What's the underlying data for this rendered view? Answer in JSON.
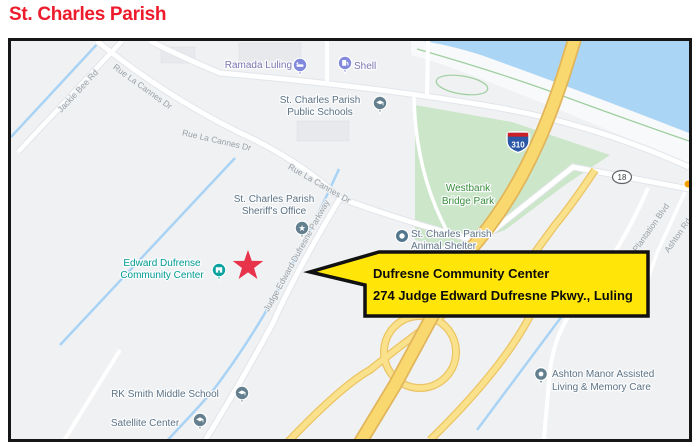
{
  "page": {
    "title": "St. Charles Parish"
  },
  "map": {
    "callout": {
      "line1": "Dufresne Community Center",
      "line2": "274 Judge Edward Dufresne Pkwy., Luling"
    },
    "park": {
      "line1": "Westbank",
      "line2": "Bridge Park"
    },
    "pois": {
      "ramada": {
        "label": "Ramada Luling"
      },
      "shell": {
        "label": "Shell"
      },
      "public_schools": {
        "line1": "St. Charles Parish",
        "line2": "Public Schools"
      },
      "sheriff": {
        "line1": "St. Charles Parish",
        "line2": "Sheriff's Office"
      },
      "community_center": {
        "line1": "Edward Dufrense",
        "line2": "Community Center"
      },
      "animal_shelter": {
        "line1": "St. Charles Parish",
        "line2": "Animal Shelter"
      },
      "rk_smith": {
        "label": "RK Smith Middle School"
      },
      "satellite": {
        "label": "Satellite Center"
      },
      "ashton_manor": {
        "line1": "Ashton Manor Assisted",
        "line2": "Living & Memory Care"
      }
    },
    "roads": {
      "jackie_bee": "Jackie Bee Rd",
      "rue_la_cannes": "Rue La Cannes Dr",
      "judge_parkway": "Judge Edward Dufresne Parkway",
      "ashton_plantation": "Ashton Plantation Blvd",
      "ashton_rd": "Ashton Rd"
    },
    "shields": {
      "interstate": "310",
      "route": "18"
    },
    "colors": {
      "title_red": "#ee1b2d",
      "star": "#e8344b",
      "callout_fill": "#ffe608",
      "water": "#abd5f5",
      "park_green": "#cbe6c9",
      "highway_yellow": "#f9d96f",
      "ramp_yellow": "#fae18c",
      "pin_gray": "#64808f",
      "pin_teal": "#0aa3a0",
      "pin_purple": "#8289dd"
    }
  }
}
